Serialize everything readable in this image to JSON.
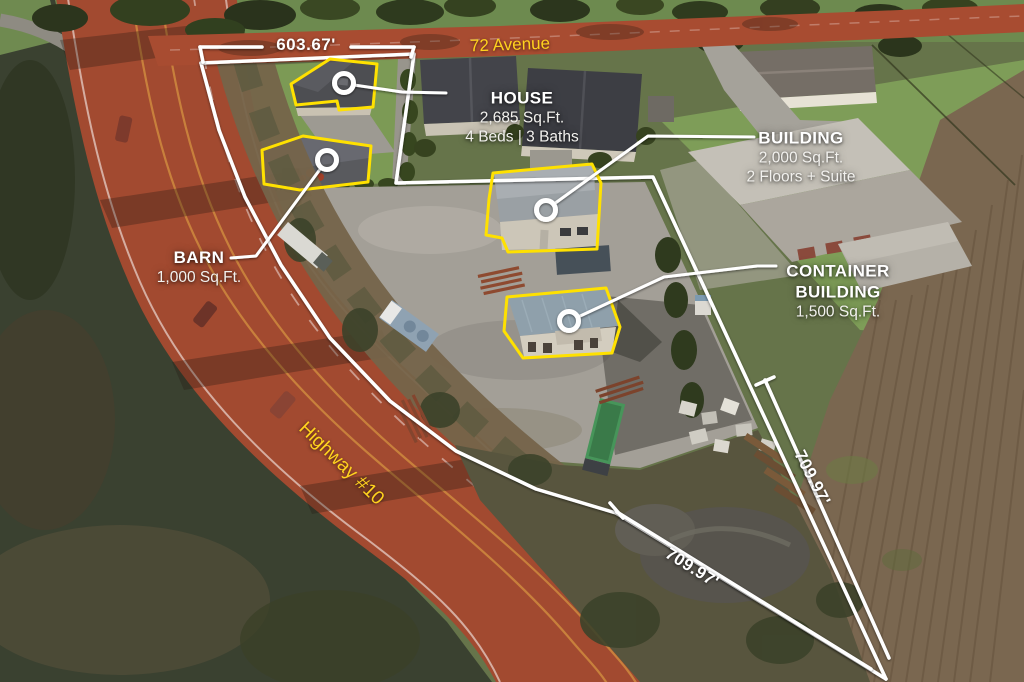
{
  "property": {
    "streets": {
      "top": "72 Avenue",
      "left": "Highway #10"
    },
    "dimensions": {
      "front": "603.67'",
      "east": "709.97'",
      "south": "709.97'"
    },
    "callouts": {
      "house": {
        "title": "HOUSE",
        "area": "2,685 Sq.Ft.",
        "extra": "4 Beds | 3 Baths"
      },
      "building": {
        "title": "BUILDING",
        "area": "2,000 Sq.Ft.",
        "extra": "2 Floors + Suite"
      },
      "barn": {
        "title": "BARN",
        "area": "1,000 Sq.Ft."
      },
      "container": {
        "title": "CONTAINER BUILDING",
        "area": "1,500 Sq.Ft."
      }
    },
    "colors": {
      "boundary_line": "#ffffff",
      "building_outline": "#ffe100",
      "road_overlay": "#a84c31",
      "street_label": "#ffd21e"
    }
  }
}
